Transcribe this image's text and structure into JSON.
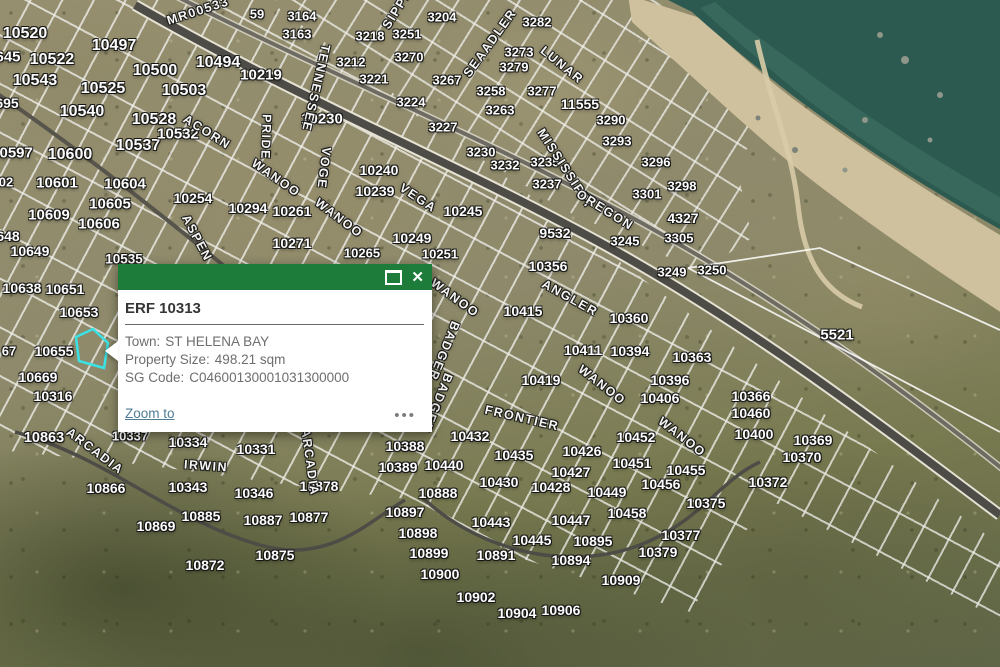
{
  "popup": {
    "title": "ERF 10313",
    "fields": [
      {
        "label": "Town:",
        "value": "ST HELENA BAY"
      },
      {
        "label": "Property Size:",
        "value": "498.21 sqm"
      },
      {
        "label": "SG Code:",
        "value": "C04600130001031300000"
      }
    ],
    "zoom_to_label": "Zoom to",
    "more_label": "•••",
    "icons": {
      "maximize": "maximize-icon",
      "close": "close-icon"
    },
    "colors": {
      "header_green": "#1e7c3a",
      "link_blue": "#4d7c94",
      "body_text": "#6e6e6e"
    }
  },
  "map": {
    "selection_color": "#3ae2e6",
    "water_color": "#2c5a50",
    "parcel_labels": [
      {
        "t": "10494",
        "x": 218,
        "y": 63,
        "s": 16
      },
      {
        "t": "10520",
        "x": 25,
        "y": 34,
        "s": 16
      },
      {
        "t": "10497",
        "x": 114,
        "y": 46,
        "s": 16
      },
      {
        "t": "645",
        "x": 8,
        "y": 57,
        "s": 15
      },
      {
        "t": "10522",
        "x": 52,
        "y": 60,
        "s": 16
      },
      {
        "t": "10543",
        "x": 35,
        "y": 81,
        "s": 16
      },
      {
        "t": "10500",
        "x": 155,
        "y": 71,
        "s": 16
      },
      {
        "t": "10525",
        "x": 103,
        "y": 89,
        "s": 16
      },
      {
        "t": "10503",
        "x": 184,
        "y": 91,
        "s": 16
      },
      {
        "t": "695",
        "x": 7,
        "y": 103,
        "s": 14
      },
      {
        "t": "10540",
        "x": 82,
        "y": 112,
        "s": 16
      },
      {
        "t": "10528",
        "x": 154,
        "y": 120,
        "s": 16
      },
      {
        "t": "10537",
        "x": 138,
        "y": 146,
        "s": 16
      },
      {
        "t": "10597",
        "x": 12,
        "y": 153,
        "s": 15
      },
      {
        "t": "10600",
        "x": 70,
        "y": 155,
        "s": 16
      },
      {
        "t": "10601",
        "x": 57,
        "y": 183,
        "s": 15
      },
      {
        "t": "02",
        "x": 6,
        "y": 182,
        "s": 13
      },
      {
        "t": "10604",
        "x": 125,
        "y": 184,
        "s": 15
      },
      {
        "t": "10532",
        "x": 178,
        "y": 134,
        "s": 15
      },
      {
        "t": "10254",
        "x": 193,
        "y": 198,
        "s": 14
      },
      {
        "t": "10605",
        "x": 110,
        "y": 204,
        "s": 15
      },
      {
        "t": "10609",
        "x": 49,
        "y": 215,
        "s": 15
      },
      {
        "t": "10606",
        "x": 99,
        "y": 224,
        "s": 15
      },
      {
        "t": "648",
        "x": 8,
        "y": 236,
        "s": 14
      },
      {
        "t": "10649",
        "x": 30,
        "y": 251,
        "s": 14
      },
      {
        "t": "10638",
        "x": 22,
        "y": 288,
        "s": 14
      },
      {
        "t": "10651",
        "x": 65,
        "y": 289,
        "s": 14
      },
      {
        "t": "10653",
        "x": 79,
        "y": 312,
        "s": 14
      },
      {
        "t": "67",
        "x": 9,
        "y": 351,
        "s": 13
      },
      {
        "t": "10655",
        "x": 54,
        "y": 351,
        "s": 14
      },
      {
        "t": "10669",
        "x": 38,
        "y": 377,
        "s": 14
      },
      {
        "t": "10316",
        "x": 53,
        "y": 396,
        "s": 14
      },
      {
        "t": "10863",
        "x": 44,
        "y": 438,
        "s": 14.5
      },
      {
        "t": "10535",
        "x": 124,
        "y": 259,
        "s": 13.5
      },
      {
        "t": "10294",
        "x": 248,
        "y": 208,
        "s": 14
      },
      {
        "t": "10219",
        "x": 261,
        "y": 75,
        "s": 15
      },
      {
        "t": "10230",
        "x": 322,
        "y": 119,
        "s": 15
      },
      {
        "t": "10240",
        "x": 379,
        "y": 170,
        "s": 14
      },
      {
        "t": "10239",
        "x": 375,
        "y": 191,
        "s": 14
      },
      {
        "t": "10245",
        "x": 463,
        "y": 211,
        "s": 14
      },
      {
        "t": "10261",
        "x": 292,
        "y": 211,
        "s": 14
      },
      {
        "t": "10249",
        "x": 412,
        "y": 238,
        "s": 14
      },
      {
        "t": "10251",
        "x": 440,
        "y": 254,
        "s": 13
      },
      {
        "t": "10265",
        "x": 362,
        "y": 253,
        "s": 13
      },
      {
        "t": "10271",
        "x": 292,
        "y": 243,
        "s": 14
      },
      {
        "t": "9532",
        "x": 555,
        "y": 233,
        "s": 14
      },
      {
        "t": "10356",
        "x": 548,
        "y": 266,
        "s": 14
      },
      {
        "t": "59",
        "x": 257,
        "y": 14,
        "s": 13
      },
      {
        "t": "3164",
        "x": 302,
        "y": 16,
        "s": 13
      },
      {
        "t": "3163",
        "x": 297,
        "y": 34,
        "s": 13
      },
      {
        "t": "3218",
        "x": 370,
        "y": 36,
        "s": 13
      },
      {
        "t": "3212",
        "x": 351,
        "y": 62,
        "s": 13
      },
      {
        "t": "3221",
        "x": 374,
        "y": 79,
        "s": 13
      },
      {
        "t": "3224",
        "x": 411,
        "y": 102,
        "s": 13
      },
      {
        "t": "3227",
        "x": 443,
        "y": 127,
        "s": 13
      },
      {
        "t": "3230",
        "x": 481,
        "y": 152,
        "s": 13
      },
      {
        "t": "3232",
        "x": 505,
        "y": 165,
        "s": 13
      },
      {
        "t": "3235",
        "x": 545,
        "y": 162,
        "s": 13
      },
      {
        "t": "3237",
        "x": 547,
        "y": 184,
        "s": 13
      },
      {
        "t": "3251",
        "x": 407,
        "y": 34,
        "s": 13
      },
      {
        "t": "3270",
        "x": 409,
        "y": 57,
        "s": 13
      },
      {
        "t": "3267",
        "x": 447,
        "y": 80,
        "s": 13
      },
      {
        "t": "3204",
        "x": 442,
        "y": 17,
        "s": 13
      },
      {
        "t": "3258",
        "x": 491,
        "y": 91,
        "s": 13
      },
      {
        "t": "3263",
        "x": 500,
        "y": 110,
        "s": 13
      },
      {
        "t": "3273",
        "x": 519,
        "y": 52,
        "s": 13
      },
      {
        "t": "3279",
        "x": 514,
        "y": 67,
        "s": 13
      },
      {
        "t": "3277",
        "x": 542,
        "y": 91,
        "s": 13
      },
      {
        "t": "3282",
        "x": 537,
        "y": 22,
        "s": 13
      },
      {
        "t": "11555",
        "x": 580,
        "y": 104,
        "s": 14
      },
      {
        "t": "3290",
        "x": 611,
        "y": 120,
        "s": 13
      },
      {
        "t": "3293",
        "x": 617,
        "y": 141,
        "s": 13
      },
      {
        "t": "3296",
        "x": 656,
        "y": 162,
        "s": 13
      },
      {
        "t": "3298",
        "x": 682,
        "y": 186,
        "s": 13
      },
      {
        "t": "3301",
        "x": 647,
        "y": 194,
        "s": 13
      },
      {
        "t": "4327",
        "x": 683,
        "y": 218,
        "s": 14
      },
      {
        "t": "3305",
        "x": 679,
        "y": 238,
        "s": 13
      },
      {
        "t": "3245",
        "x": 625,
        "y": 241,
        "s": 13
      },
      {
        "t": "3249",
        "x": 672,
        "y": 272,
        "s": 13
      },
      {
        "t": "3250",
        "x": 712,
        "y": 270,
        "s": 13
      },
      {
        "t": "5521",
        "x": 837,
        "y": 335,
        "s": 15
      },
      {
        "t": "10363",
        "x": 692,
        "y": 357,
        "s": 14
      },
      {
        "t": "10394",
        "x": 630,
        "y": 351,
        "s": 14
      },
      {
        "t": "10411",
        "x": 583,
        "y": 350,
        "s": 14
      },
      {
        "t": "10415",
        "x": 523,
        "y": 311,
        "s": 14
      },
      {
        "t": "10360",
        "x": 629,
        "y": 318,
        "s": 14
      },
      {
        "t": "10396",
        "x": 670,
        "y": 380,
        "s": 14
      },
      {
        "t": "10406",
        "x": 660,
        "y": 398,
        "s": 14
      },
      {
        "t": "10419",
        "x": 541,
        "y": 380,
        "s": 14
      },
      {
        "t": "10366",
        "x": 751,
        "y": 396,
        "s": 14
      },
      {
        "t": "10460",
        "x": 751,
        "y": 413,
        "s": 14
      },
      {
        "t": "10400",
        "x": 754,
        "y": 434,
        "s": 14
      },
      {
        "t": "10369",
        "x": 813,
        "y": 440,
        "s": 14
      },
      {
        "t": "10370",
        "x": 802,
        "y": 457,
        "s": 14
      },
      {
        "t": "10337",
        "x": 130,
        "y": 436,
        "s": 13
      },
      {
        "t": "10334",
        "x": 188,
        "y": 442,
        "s": 14
      },
      {
        "t": "10331",
        "x": 256,
        "y": 449,
        "s": 14
      },
      {
        "t": "10343",
        "x": 188,
        "y": 487,
        "s": 14
      },
      {
        "t": "10346",
        "x": 254,
        "y": 493,
        "s": 14
      },
      {
        "t": "10866",
        "x": 106,
        "y": 488,
        "s": 14
      },
      {
        "t": "10869",
        "x": 156,
        "y": 526,
        "s": 14
      },
      {
        "t": "10885",
        "x": 201,
        "y": 516,
        "s": 14
      },
      {
        "t": "10887",
        "x": 263,
        "y": 520,
        "s": 14
      },
      {
        "t": "10877",
        "x": 309,
        "y": 517,
        "s": 14
      },
      {
        "t": "10872",
        "x": 205,
        "y": 565,
        "s": 14
      },
      {
        "t": "10875",
        "x": 275,
        "y": 555,
        "s": 14
      },
      {
        "t": "10878",
        "x": 319,
        "y": 486,
        "s": 14
      },
      {
        "t": "10388",
        "x": 405,
        "y": 446,
        "s": 14
      },
      {
        "t": "10389",
        "x": 398,
        "y": 467,
        "s": 14
      },
      {
        "t": "10440",
        "x": 444,
        "y": 465,
        "s": 14
      },
      {
        "t": "10430",
        "x": 499,
        "y": 482,
        "s": 14
      },
      {
        "t": "10432",
        "x": 470,
        "y": 436,
        "s": 14
      },
      {
        "t": "10435",
        "x": 514,
        "y": 455,
        "s": 14
      },
      {
        "t": "10426",
        "x": 582,
        "y": 451,
        "s": 14
      },
      {
        "t": "10427",
        "x": 571,
        "y": 472,
        "s": 14
      },
      {
        "t": "10428",
        "x": 551,
        "y": 487,
        "s": 14
      },
      {
        "t": "10443",
        "x": 491,
        "y": 522,
        "s": 14
      },
      {
        "t": "10445",
        "x": 532,
        "y": 540,
        "s": 14
      },
      {
        "t": "10447",
        "x": 571,
        "y": 520,
        "s": 14
      },
      {
        "t": "10449",
        "x": 607,
        "y": 492,
        "s": 14
      },
      {
        "t": "10451",
        "x": 632,
        "y": 463,
        "s": 14
      },
      {
        "t": "10452",
        "x": 636,
        "y": 437,
        "s": 14
      },
      {
        "t": "10455",
        "x": 686,
        "y": 470,
        "s": 14
      },
      {
        "t": "10456",
        "x": 661,
        "y": 484,
        "s": 14
      },
      {
        "t": "10458",
        "x": 627,
        "y": 513,
        "s": 14
      },
      {
        "t": "10888",
        "x": 438,
        "y": 493,
        "s": 14
      },
      {
        "t": "10897",
        "x": 405,
        "y": 512,
        "s": 14
      },
      {
        "t": "10898",
        "x": 418,
        "y": 533,
        "s": 14
      },
      {
        "t": "10899",
        "x": 429,
        "y": 553,
        "s": 14
      },
      {
        "t": "10891",
        "x": 496,
        "y": 555,
        "s": 14
      },
      {
        "t": "10894",
        "x": 571,
        "y": 560,
        "s": 14
      },
      {
        "t": "10895",
        "x": 593,
        "y": 541,
        "s": 14
      },
      {
        "t": "10900",
        "x": 440,
        "y": 574,
        "s": 14
      },
      {
        "t": "10902",
        "x": 476,
        "y": 597,
        "s": 14
      },
      {
        "t": "10904",
        "x": 517,
        "y": 613,
        "s": 14
      },
      {
        "t": "10906",
        "x": 561,
        "y": 610,
        "s": 14
      },
      {
        "t": "10909",
        "x": 621,
        "y": 580,
        "s": 14
      },
      {
        "t": "10372",
        "x": 768,
        "y": 482,
        "s": 14
      },
      {
        "t": "10375",
        "x": 706,
        "y": 503,
        "s": 14
      },
      {
        "t": "10377",
        "x": 681,
        "y": 535,
        "s": 14
      },
      {
        "t": "10379",
        "x": 658,
        "y": 552,
        "s": 14
      }
    ],
    "street_labels": [
      {
        "t": "TENNESSEE",
        "x": 316,
        "y": 88,
        "r": 103
      },
      {
        "t": "SIPPI",
        "x": 396,
        "y": 11,
        "r": -58
      },
      {
        "t": "MISSISSIPPI",
        "x": 565,
        "y": 168,
        "r": 57
      },
      {
        "t": "PRIDE",
        "x": 266,
        "y": 137,
        "r": 92
      },
      {
        "t": "ACORN",
        "x": 207,
        "y": 132,
        "r": 32
      },
      {
        "t": "MR00533",
        "x": 198,
        "y": 11,
        "r": -18
      },
      {
        "t": "VOGE",
        "x": 324,
        "y": 168,
        "r": 97
      },
      {
        "t": "WANOO",
        "x": 276,
        "y": 178,
        "r": 35
      },
      {
        "t": "WANOO",
        "x": 339,
        "y": 218,
        "r": 37
      },
      {
        "t": "WANOO",
        "x": 455,
        "y": 298,
        "r": 36
      },
      {
        "t": "WANOO",
        "x": 602,
        "y": 385,
        "r": 38
      },
      {
        "t": "WANOO",
        "x": 682,
        "y": 437,
        "r": 38
      },
      {
        "t": "VEGA",
        "x": 418,
        "y": 198,
        "r": 34
      },
      {
        "t": "ASPEN",
        "x": 197,
        "y": 238,
        "r": 62
      },
      {
        "t": "OREGON",
        "x": 605,
        "y": 210,
        "r": 32
      },
      {
        "t": "LUNAR",
        "x": 562,
        "y": 65,
        "r": 39
      },
      {
        "t": "SEAADLER",
        "x": 490,
        "y": 43,
        "r": -54
      },
      {
        "t": "ANGLER",
        "x": 570,
        "y": 298,
        "r": 29
      },
      {
        "t": "BADGER",
        "x": 444,
        "y": 351,
        "r": 112
      },
      {
        "t": "BADGER",
        "x": 437,
        "y": 403,
        "r": 112
      },
      {
        "t": "FRONTIER",
        "x": 522,
        "y": 418,
        "r": 13
      },
      {
        "t": "ARCADIA",
        "x": 95,
        "y": 451,
        "r": 37
      },
      {
        "t": "ARCADIA",
        "x": 310,
        "y": 462,
        "r": 82
      },
      {
        "t": "IRWIN",
        "x": 206,
        "y": 466,
        "r": 4
      }
    ]
  }
}
